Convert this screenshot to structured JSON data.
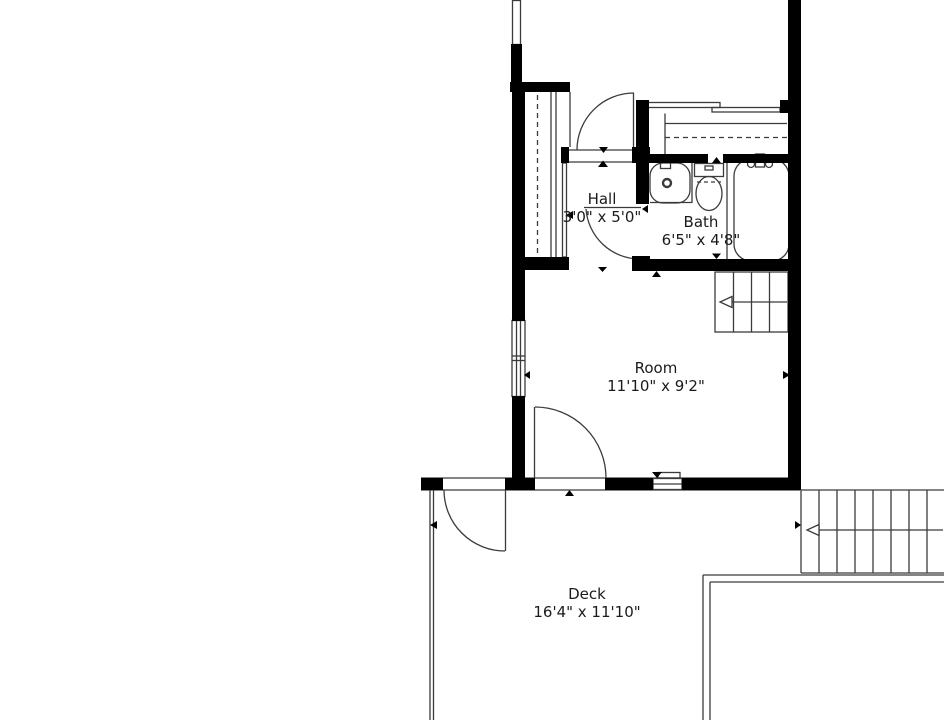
{
  "floor_plan": {
    "title": "Floor plan",
    "rooms": [
      {
        "id": "hall",
        "name": "Hall",
        "dimensions": "3'0\" x 5'0\""
      },
      {
        "id": "bath",
        "name": "Bath",
        "dimensions": "6'5\" x 4'8\""
      },
      {
        "id": "room",
        "name": "Room",
        "dimensions": "11'10\" x 9'2\""
      },
      {
        "id": "deck",
        "name": "Deck",
        "dimensions": "16'4\" x 11'10\""
      }
    ],
    "fixtures": [
      "sink",
      "toilet",
      "bathtub",
      "hall-closet",
      "linen-closet-sliding-doors"
    ],
    "stairs": [
      "interior-stairs",
      "exterior-deck-stairs"
    ],
    "colors": {
      "wall": "#000000",
      "line": "#3b3b3b",
      "text": "#1b1b1b",
      "background": "#ffffff"
    }
  }
}
